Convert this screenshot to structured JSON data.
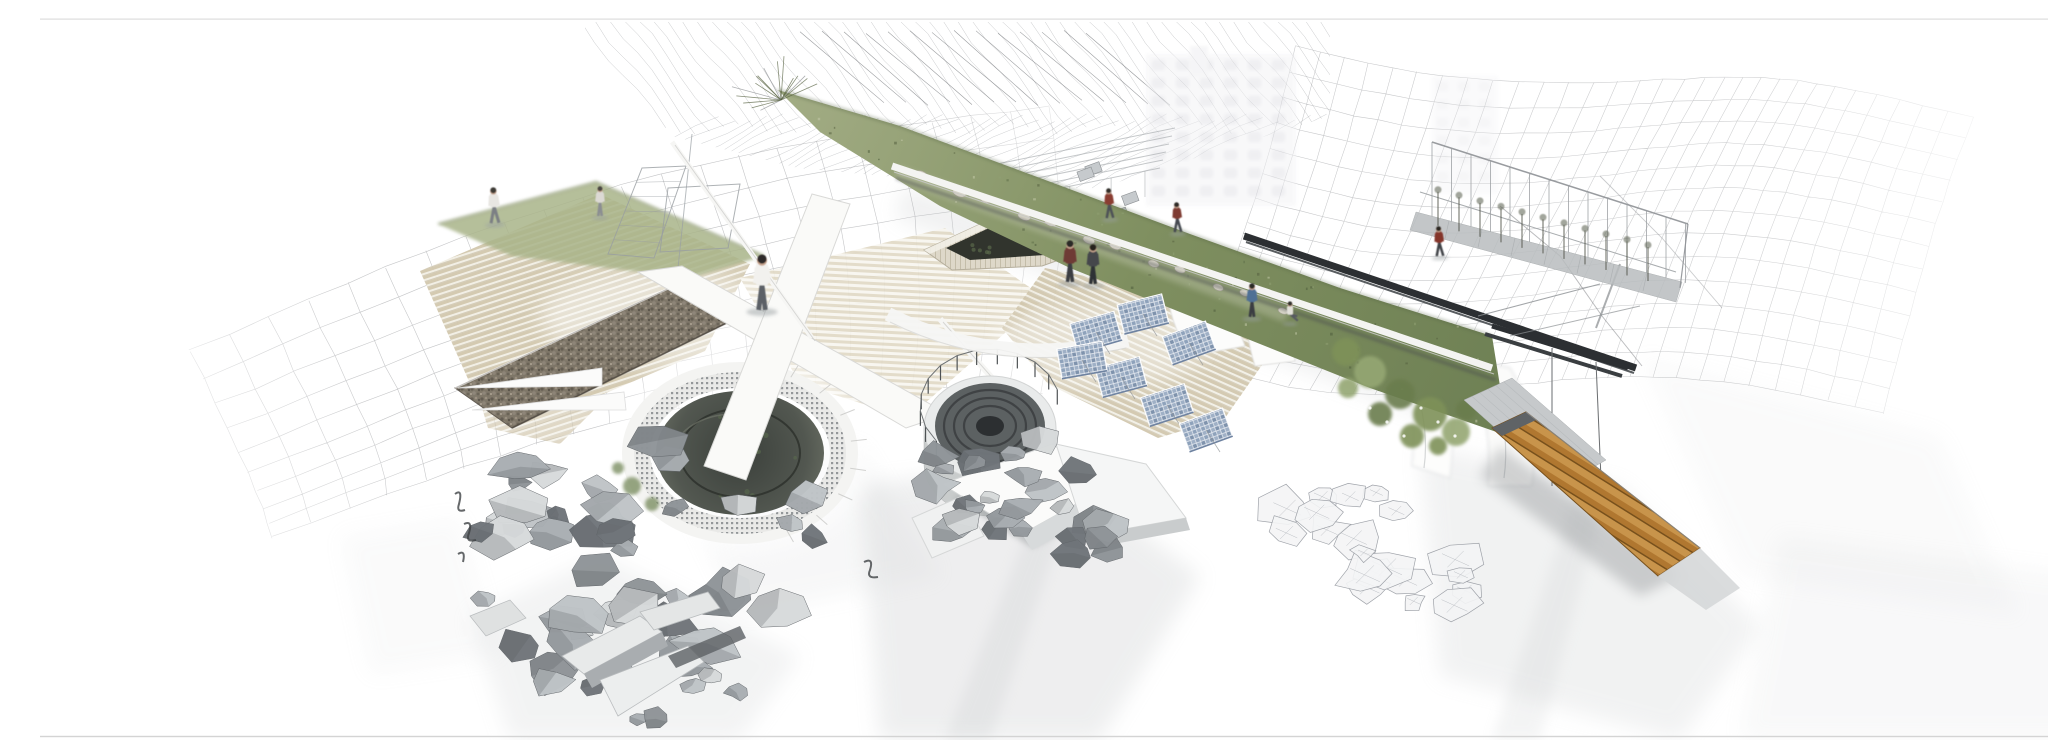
{
  "title": "Architectural collage rendering",
  "scene": {
    "description": "Aerial architectural collage rendering: a diagonal elevated green-roof park strip with people, two sunken circular tanks wrapped in perforated screens, terraced timber steps, a gabion stone wall, scaffolding frames, a slanted greenhouse structure, blue solar-panel clusters, piles of grey rubble, white broken slabs, a timber ramp at lower right, soft grey ground shadows, all set against faint wireframe terrain meshes on a white background.",
    "elements": [
      "wireframe-terrain-mesh-left",
      "wireframe-hatch-mesh-top",
      "wireframe-terrain-mesh-right",
      "ghost-building-backdrop",
      "terraced-timber-steps",
      "gabion-stone-wall",
      "grass-slope",
      "scaffolding-frames",
      "sunken-pool-left",
      "white-walkway-ramps",
      "circular-tank-middle",
      "stone-planter",
      "green-roof-park-strip",
      "greenhouse-frame",
      "dark-steel-rails",
      "solar-panel-cluster",
      "rubble-piles",
      "broken-white-slabs",
      "timber-ramp",
      "people-figures",
      "ground-shadows"
    ],
    "people": [
      {
        "x": 455,
        "y": 207,
        "h": 36,
        "shirt": "#e8e6e2",
        "pants": "#7c7f84",
        "hair": "#3c3a36",
        "pose": "walk"
      },
      {
        "x": 560,
        "y": 200,
        "h": 30,
        "shirt": "#dcd9d4",
        "pants": "#8b8e92",
        "hair": "#4a4742",
        "pose": "stand"
      },
      {
        "x": 722,
        "y": 294,
        "h": 56,
        "shirt": "#f2f1ee",
        "pants": "#5c6066",
        "hair": "#2e2c29",
        "pose": "stand"
      },
      {
        "x": 1030,
        "y": 266,
        "h": 42,
        "shirt": "#6e3a35",
        "pants": "#3a3d42",
        "hair": "#2b2926",
        "pose": "stand"
      },
      {
        "x": 1053,
        "y": 268,
        "h": 40,
        "shirt": "#44474c",
        "pants": "#2f3235",
        "hair": "#26241f",
        "pose": "stand"
      },
      {
        "x": 1070,
        "y": 202,
        "h": 30,
        "shirt": "#8a3c30",
        "pants": "#4e5156",
        "hair": "#302e2a",
        "pose": "walk"
      },
      {
        "x": 1138,
        "y": 216,
        "h": 30,
        "shirt": "#7e3b31",
        "pants": "#454850",
        "hair": "#2d2b28",
        "pose": "walk"
      },
      {
        "x": 1212,
        "y": 301,
        "h": 34,
        "shirt": "#4f6f95",
        "pants": "#3b3e43",
        "hair": "#2c2a27",
        "pose": "stand"
      },
      {
        "x": 1250,
        "y": 306,
        "h": 26,
        "shirt": "#e3e1da",
        "pants": "#565a60",
        "hair": "#33312d",
        "pose": "sit"
      },
      {
        "x": 1400,
        "y": 240,
        "h": 30,
        "shirt": "#84352c",
        "pants": "#3f4247",
        "hair": "#2a2824",
        "pose": "walk"
      }
    ],
    "colors": {
      "background": "#ffffff",
      "mesh_line": "#97999d",
      "steps_tan": "#d2c7ad",
      "steps_light": "#f1eee4",
      "gabion_brown": "#77705f",
      "grass_base": "#8a9a6b",
      "grass_dark": "#5f7048",
      "grass_light": "#b9c19c",
      "pit_dark": "#474c45",
      "tank_gray": "#5a5f60",
      "panel_blue": "#a9b9ce",
      "panel_blue_dark": "#7f93ad",
      "rock_gray": "#a9aeb2",
      "rock_light": "#d7dadb",
      "rock_dark": "#70757a",
      "wood_orange": "#b07730",
      "wood_light": "#c8944b",
      "wood_dark": "#77501c",
      "rail_dark": "#2c2f32",
      "shadow_gray": "#c3c6c8",
      "fascia_white": "#f4f4f2",
      "drape_white": "#fcfcfb",
      "planter_stone": "#ded8c9",
      "skin": "#c9a58f"
    }
  }
}
